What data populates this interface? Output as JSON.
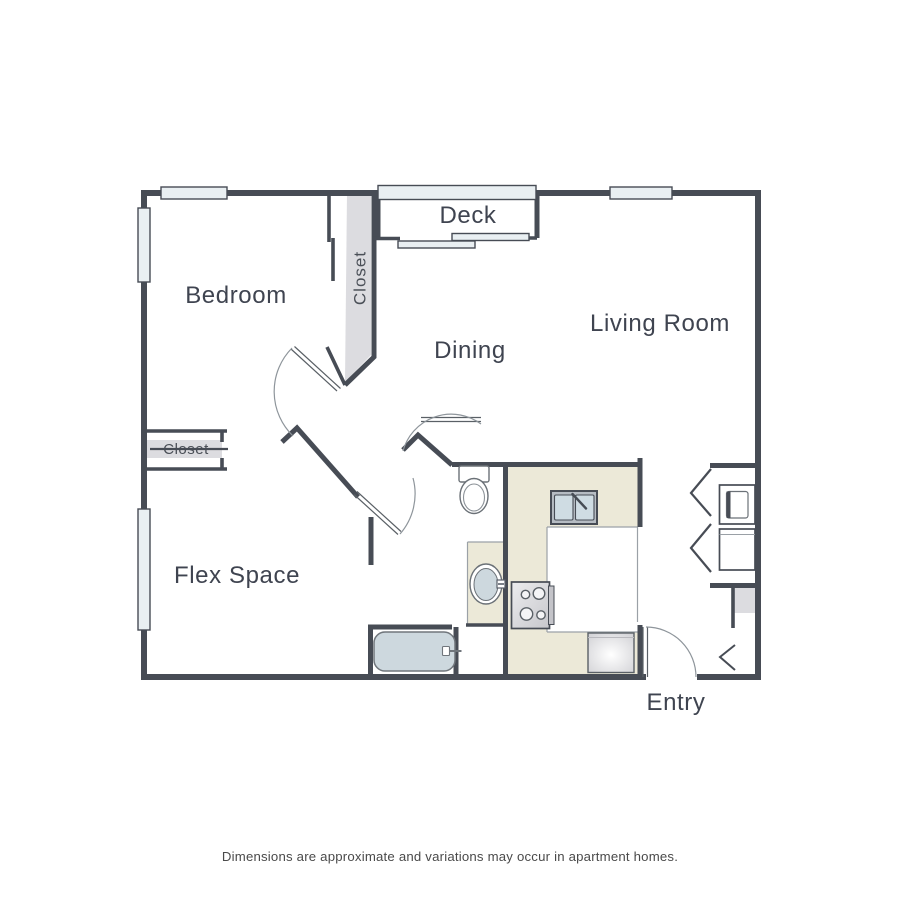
{
  "floorplan": {
    "labels": {
      "bedroom": "Bedroom",
      "deck": "Deck",
      "dining": "Dining",
      "living_room": "Living Room",
      "flex_space": "Flex Space",
      "entry": "Entry",
      "bedroom_closet": "Closet",
      "flex_closet": "Closet"
    },
    "disclaimer": "Dimensions are approximate and variations may occur in apartment homes.",
    "colors": {
      "wall": "#474c55",
      "window_fill": "#e9eff2",
      "counter_fill": "#ece9d8",
      "closet_fill": "#dcdce0",
      "fixture_fill": "#cdd8de",
      "arc_stroke": "#8e959b",
      "label_text": "#3f4450",
      "disclaimer_text": "#4a4a4a"
    },
    "fixtures": {
      "kitchen": [
        "kitchen-sink",
        "stove",
        "refrigerator"
      ],
      "bathroom": [
        "toilet",
        "vanity-sink",
        "bathtub"
      ],
      "laundry": [
        "dryer",
        "washer"
      ]
    }
  }
}
